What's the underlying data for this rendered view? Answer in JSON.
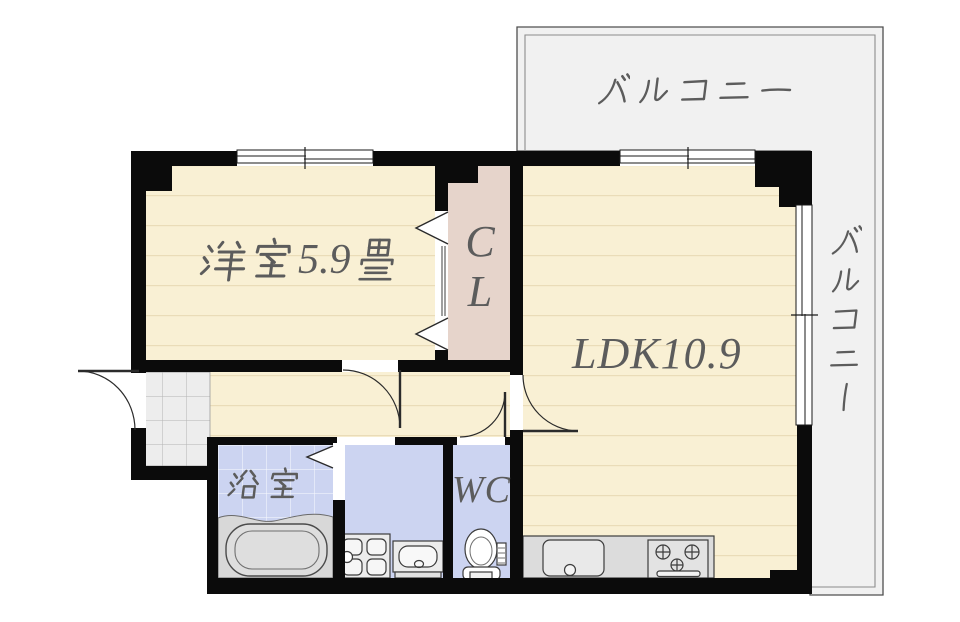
{
  "floor_plan": {
    "balconies": {
      "top": {
        "label": "バルコニー"
      },
      "right": {
        "label": "バルコニー"
      }
    },
    "rooms": {
      "western_room": {
        "label": "洋室5.9畳",
        "name": "洋室",
        "size_number": "5.9",
        "size_unit": "畳"
      },
      "closet": {
        "label": "CL",
        "lines": [
          "C",
          "L"
        ]
      },
      "ldk": {
        "label": "LDK10.9"
      },
      "bathroom": {
        "label": "浴室"
      },
      "toilet_room": {
        "label": "WC"
      }
    },
    "fixtures": {
      "bathtub": "bathtub",
      "washing_machine_pan": "washing-machine-pan",
      "wash_basin": "wash-basin",
      "toilet": "toilet",
      "kitchen_counter": "kitchen-counter",
      "kitchen_sink": "kitchen-sink",
      "gas_stove": "gas-stove"
    },
    "colors": {
      "wall": "#0b0b0b",
      "flooring": "#f9f0d4",
      "flooring_stripe": "#eee0bf",
      "closet_fill": "#e6d4cb",
      "wet_area_fill": "#ccd4f1",
      "entrance_tile": "#ededed",
      "balcony_fill": "#f1f1f1",
      "fixture_gray": "#d8d8d8",
      "label_text": "#5c5c5c"
    }
  }
}
